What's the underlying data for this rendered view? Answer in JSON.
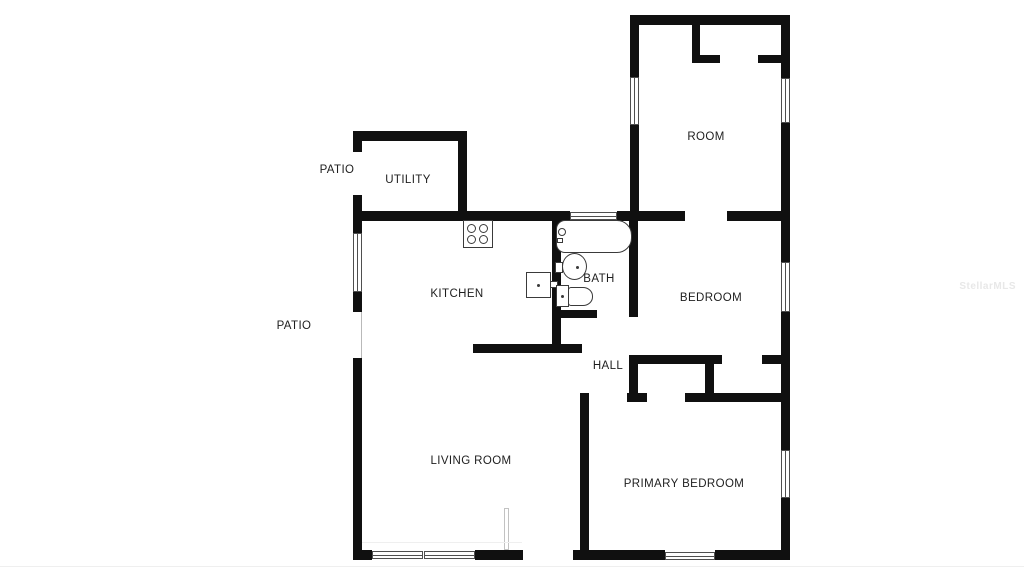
{
  "floorplan": {
    "rooms": {
      "room": "ROOM",
      "utility": "UTILITY",
      "kitchen": "KITCHEN",
      "bath": "BATH",
      "bedroom": "BEDROOM",
      "hall": "HALL",
      "living_room": "LIVING ROOM",
      "primary_bedroom": "PRIMARY BEDROOM"
    },
    "outdoor": {
      "patio_upper": "PATIO",
      "patio_lower": "PATIO"
    },
    "watermark": "StellarMLS",
    "colors": {
      "wall": "#101010",
      "background": "#ffffff",
      "fixture_outline": "#3a3a3a",
      "label_text": "#1e1e1e",
      "watermark": "#e8e8e8"
    },
    "fixtures": [
      "stove-icon",
      "kitchen-sink-icon",
      "bathtub-icon",
      "bathroom-sink-icon",
      "toilet-icon",
      "door-leaf-icon"
    ]
  }
}
